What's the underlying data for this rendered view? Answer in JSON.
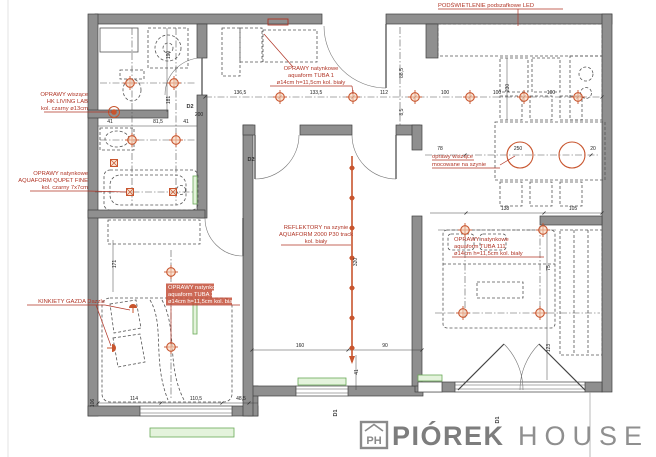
{
  "colors": {
    "wall": "#8f8f8f",
    "wall_stroke": "#3f3f3f",
    "annotation_red": "#b03425",
    "lamp_orange": "#c8552e",
    "window_green": "#6aaa58",
    "logo_gray": "#8a8a8a",
    "background": "#ffffff"
  },
  "logo": {
    "initials": "PH",
    "brand_bold": "PIÓREK",
    "brand_light": "HOUSE"
  },
  "plan": {
    "annotations": [
      {
        "id": "oprawy-wiszace-hk",
        "lines": [
          "OPRAWY wiszące",
          "HK LIVING LAB",
          "kol. czarny ø13cm"
        ],
        "x": 88,
        "ys": [
          96,
          103,
          110
        ],
        "anchor": "end",
        "u": [
          [
            44,
            112,
            88,
            112
          ]
        ],
        "leaders": [
          [
            88,
            112,
            112,
            112
          ]
        ]
      },
      {
        "id": "qupet-fine",
        "lines": [
          "OPRAWY natynkowe",
          "AQUAFORM QUPET FINE",
          "kol. czarny 7x7cm"
        ],
        "x": 88,
        "ys": [
          175,
          182,
          189
        ],
        "anchor": "end",
        "u": [
          [
            30,
            191,
            88,
            191
          ]
        ],
        "leaders": [
          [
            88,
            191,
            127,
            192
          ]
        ]
      },
      {
        "id": "kinkiety",
        "lines": [
          "KINKIETY GAZDA Dazzle"
        ],
        "x": 105,
        "ys": [
          303
        ],
        "anchor": "end",
        "u": [
          [
            27,
            305,
            105,
            305
          ]
        ],
        "leaders": [
          [
            105,
            305,
            130,
            310
          ],
          [
            96,
            305,
            111,
            346
          ]
        ]
      },
      {
        "id": "tuba1",
        "lines": [
          "OPRAWY natynkowe",
          "aquaform TUBA 1",
          "ø14cm h=11,5cm kol. biały"
        ],
        "x": 311,
        "ys": [
          70,
          77,
          84
        ],
        "anchor": "middle",
        "u": [
          [
            270,
            86,
            352,
            86
          ]
        ],
        "leaders": [
          [
            352,
            86,
            353,
            94
          ],
          [
            293,
            67,
            264,
            34
          ]
        ]
      },
      {
        "id": "led-podszafkowe",
        "lines": [
          "PODŚWIETLENIE podszafkowe LED"
        ],
        "x": 438,
        "ys": [
          7
        ],
        "anchor": "start",
        "u": [
          [
            438,
            9,
            563,
            9
          ]
        ],
        "leaders": [
          [
            518,
            9,
            518,
            26
          ]
        ]
      },
      {
        "id": "reflektory",
        "lines": [
          "REFLEKTORY na szynie",
          "AQUAFORM 2000 P30 track",
          "kol. biały"
        ],
        "x": 316,
        "ys": [
          229,
          236,
          243
        ],
        "anchor": "middle",
        "u": [
          [
            281,
            245,
            351,
            245
          ]
        ],
        "leaders": []
      },
      {
        "id": "tuba11",
        "highlight": true,
        "lines": [
          "OPRAWY natynkowe",
          "aquaform TUBA 11",
          "ø14cm h=11,5cm kol. biały"
        ],
        "x": 168,
        "ys": [
          289,
          296,
          303
        ],
        "anchor": "start",
        "hl": [
          [
            166,
            283.5,
            48,
            7
          ],
          [
            166,
            290.5,
            46,
            7
          ],
          [
            166,
            297.5,
            66,
            7
          ]
        ],
        "u": [
          [
            166,
            305,
            240,
            305
          ]
        ],
        "leaders": [
          [
            171,
            306,
            171,
            344
          ]
        ]
      },
      {
        "id": "wiszace-szyna",
        "lines": [
          "oprawy wiszące",
          "mocowane na szynie"
        ],
        "x": 432,
        "ys": [
          158,
          166
        ],
        "anchor": "start",
        "u": [
          [
            432,
            160,
            474,
            160
          ],
          [
            432,
            168,
            500,
            168
          ]
        ],
        "leaders": [
          [
            500,
            165,
            515,
            156
          ]
        ]
      },
      {
        "id": "tuba111",
        "lines": [
          "OPRAWY natynkowe",
          "aquaform TUBA 111",
          "ø14cm h=11,5cm kol. biały"
        ],
        "x": 454,
        "ys": [
          241,
          248,
          255
        ],
        "anchor": "start",
        "u": [
          [
            452,
            257,
            544,
            257
          ]
        ],
        "leaders": []
      }
    ],
    "dimensions": [
      {
        "v": "136,5",
        "x": 240,
        "y": 94
      },
      {
        "v": "133,5",
        "x": 316,
        "y": 94
      },
      {
        "v": "112",
        "x": 384,
        "y": 94
      },
      {
        "v": "100",
        "x": 445,
        "y": 94
      },
      {
        "v": "100",
        "x": 497,
        "y": 94
      },
      {
        "v": "100",
        "x": 551,
        "y": 94
      },
      {
        "v": "41",
        "x": 110,
        "y": 123
      },
      {
        "v": "81,5",
        "x": 158,
        "y": 123
      },
      {
        "v": "41",
        "x": 186,
        "y": 123
      },
      {
        "v": "200",
        "x": 199,
        "y": 116
      },
      {
        "v": "190",
        "x": 170,
        "y": 55,
        "r": 1
      },
      {
        "v": "181",
        "x": 170,
        "y": 100,
        "r": 1
      },
      {
        "v": "88,5",
        "x": 403,
        "y": 73,
        "r": 1
      },
      {
        "v": "8,5",
        "x": 403,
        "y": 112,
        "r": 1
      },
      {
        "v": "230",
        "x": 509,
        "y": 88,
        "r": 1
      },
      {
        "v": "78",
        "x": 440,
        "y": 150
      },
      {
        "v": "250",
        "x": 518,
        "y": 150
      },
      {
        "v": "20",
        "x": 593,
        "y": 150
      },
      {
        "v": "138",
        "x": 505,
        "y": 210
      },
      {
        "v": "105",
        "x": 573,
        "y": 210
      },
      {
        "v": "75",
        "x": 550,
        "y": 268,
        "r": 1
      },
      {
        "v": "123",
        "x": 550,
        "y": 348,
        "r": 1
      },
      {
        "v": "320",
        "x": 357,
        "y": 262,
        "r": 1
      },
      {
        "v": "160",
        "x": 300,
        "y": 347
      },
      {
        "v": "90",
        "x": 385,
        "y": 347
      },
      {
        "v": "41",
        "x": 358,
        "y": 372,
        "r": 1
      },
      {
        "v": "114",
        "x": 134,
        "y": 400
      },
      {
        "v": "110,5",
        "x": 196,
        "y": 400
      },
      {
        "v": "48,5",
        "x": 241,
        "y": 400
      },
      {
        "v": "106",
        "x": 94,
        "y": 403,
        "r": 1
      },
      {
        "v": "171",
        "x": 116,
        "y": 264,
        "r": 1
      }
    ],
    "door_labels": [
      {
        "v": "D2",
        "x": 190,
        "y": 108
      },
      {
        "v": "D2",
        "x": 251,
        "y": 161
      },
      {
        "v": "D1",
        "x": 337,
        "y": 413,
        "r": 1
      },
      {
        "v": "D1",
        "x": 499,
        "y": 420,
        "r": 1
      }
    ],
    "lamps": {
      "cross": [
        [
          280,
          97
        ],
        [
          353,
          97
        ],
        [
          415,
          97
        ],
        [
          470,
          97
        ],
        [
          524,
          97
        ],
        [
          578,
          97
        ],
        [
          130,
          83
        ],
        [
          174,
          83
        ],
        [
          132,
          140
        ],
        [
          176,
          140
        ],
        [
          171,
          272
        ],
        [
          171,
          347
        ],
        [
          465,
          230
        ],
        [
          543,
          230
        ],
        [
          463,
          313
        ],
        [
          540,
          313
        ]
      ],
      "square": [
        [
          114,
          163
        ],
        [
          130,
          192
        ],
        [
          173,
          192
        ]
      ],
      "pendant_dot": [
        [
          114,
          112
        ]
      ],
      "pendant_ring": [
        [
          520,
          155
        ],
        [
          572,
          155
        ]
      ],
      "wall": [
        [
          133,
          308,
          0
        ],
        [
          112,
          348,
          90
        ]
      ],
      "track": {
        "x": 352,
        "y1": 156,
        "y2": 362,
        "dots": [
          168,
          198,
          228,
          258,
          288,
          318,
          348
        ]
      }
    }
  }
}
